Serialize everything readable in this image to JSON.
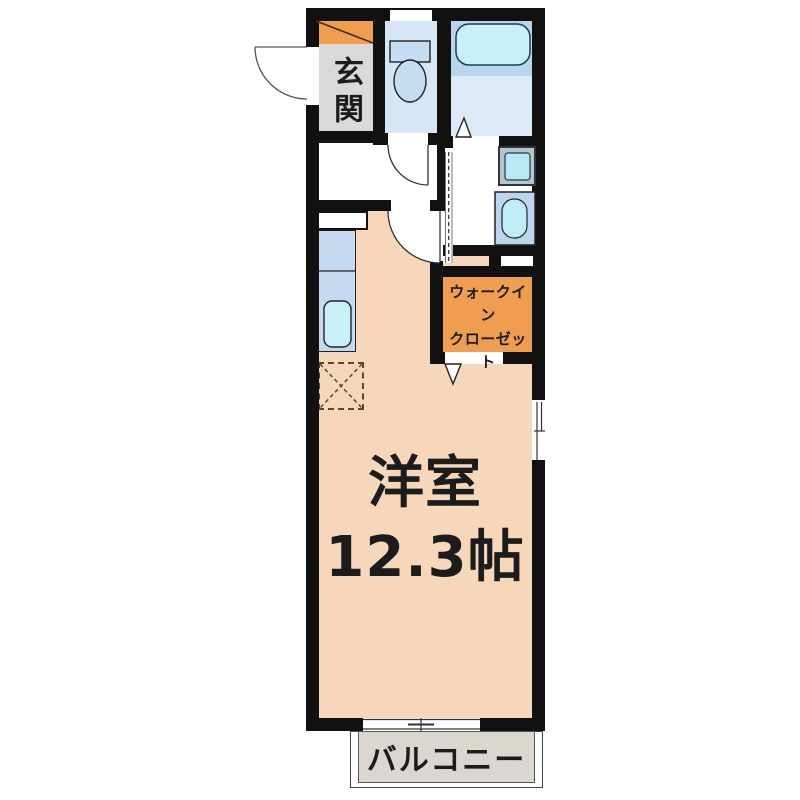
{
  "rooms": {
    "entrance": {
      "label": "玄関"
    },
    "closet": {
      "line1": "ウォークイン",
      "line2": "クローゼット"
    },
    "main": {
      "name": "洋室",
      "area": "12.3帖"
    },
    "balcony": {
      "label": "バルコニー"
    }
  },
  "fixtures": [
    "shoe-cabinet",
    "toilet",
    "bathtub",
    "washing-machine",
    "washbasin",
    "kitchen-sink",
    "refrigerator-space"
  ],
  "colors": {
    "wall": "#111111",
    "main_floor": "#F6D7BA",
    "entrance_floor": "#D9D9D9",
    "cabinet_orange": "#EF9D4E",
    "toilet_floor": "#D7E6F6",
    "bath_upper": "#BAD4EE",
    "bath_lower": "#DCE9F7",
    "kitchen_counter": "#C3DAF1",
    "balcony_floor": "#DBD6D0",
    "fixture_blue": "#C5DDF2",
    "fixture_cyan": "#C8F0F9"
  }
}
